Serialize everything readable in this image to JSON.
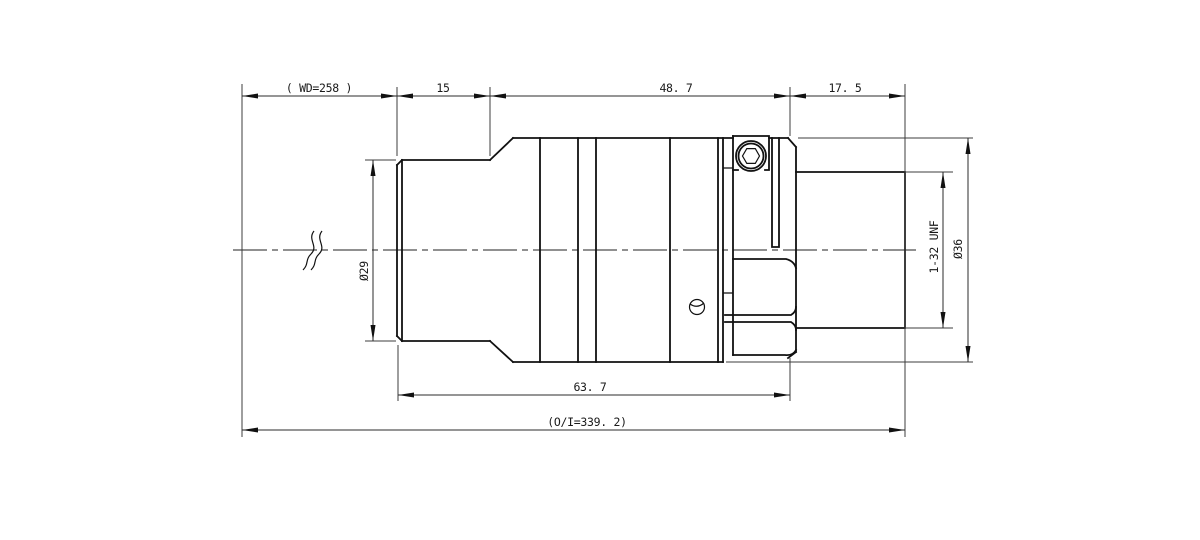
{
  "page": {
    "background": "#ffffff"
  },
  "style": {
    "object_line_color": "#111111",
    "dimension_line_color": "#2b2b2b",
    "text_color": "#1a1a1a"
  },
  "labels": {
    "wd": "( WD=258 )",
    "seg_front": "15",
    "seg_mid": "48. 7",
    "seg_rear": "17. 5",
    "dia_front": "Ø29",
    "thread": "1-32 UNF",
    "dia_body": "Ø36",
    "len_front_body": "63. 7",
    "overall": "(O/I=339. 2)"
  }
}
